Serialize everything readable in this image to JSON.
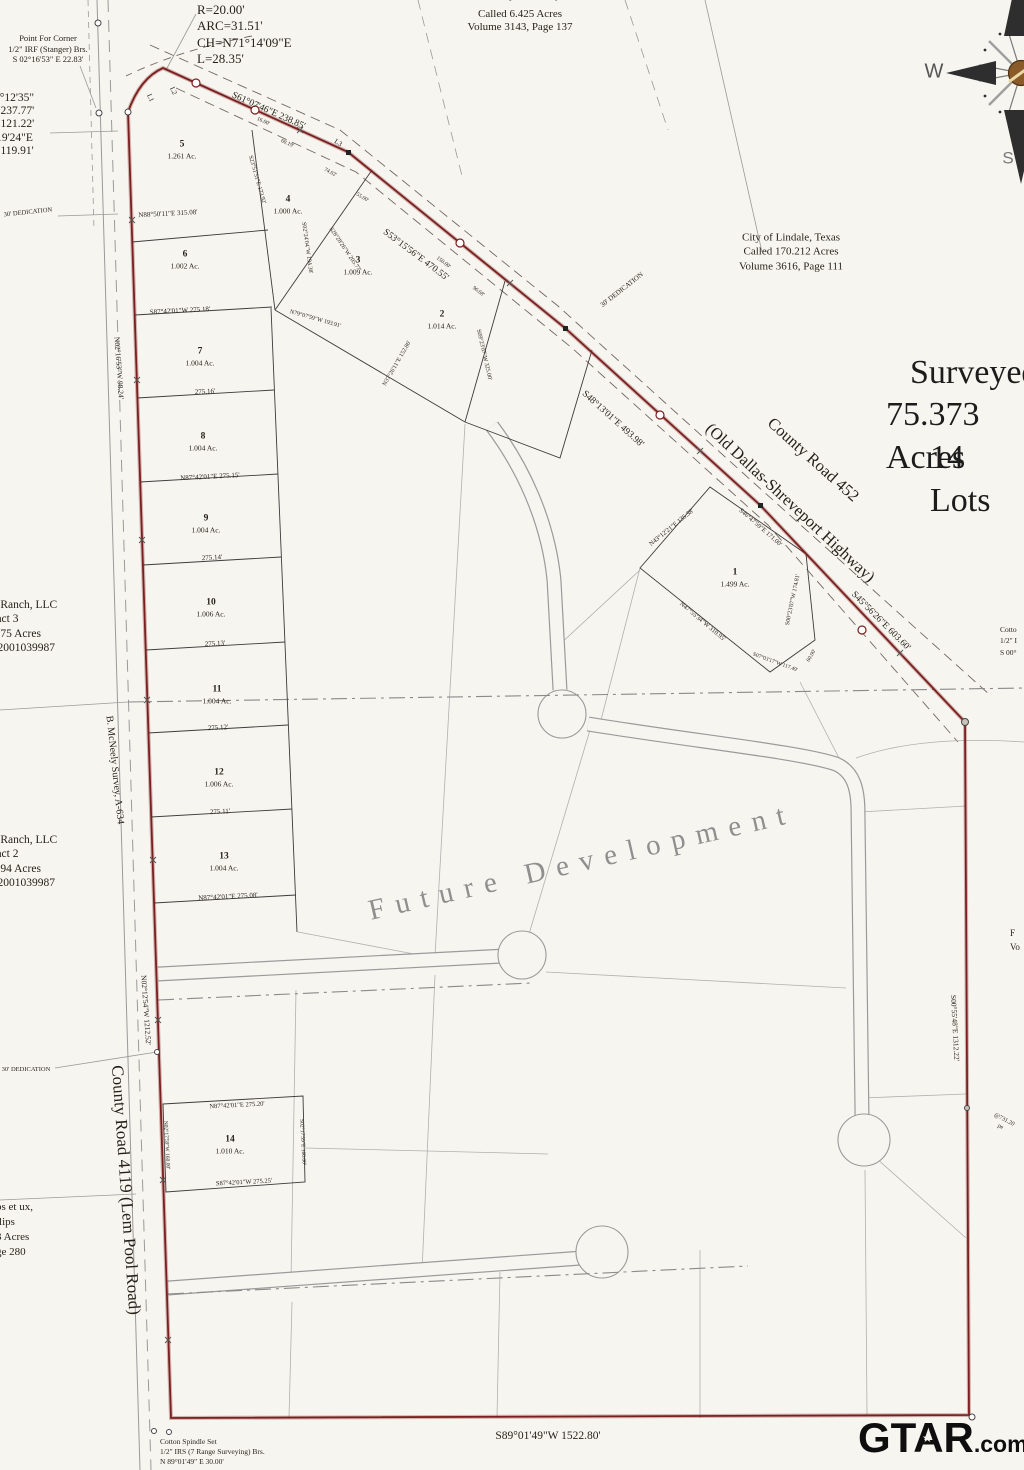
{
  "colors": {
    "paper": "#f7f5ef",
    "ink": "#241f19",
    "boundary_red": "#7a1f1f",
    "street_gray": "#9a9a9a",
    "parcel_gray": "#b0b0b0",
    "lot_line": "#3c3c3c",
    "centerline_gray": "#8a8a8a",
    "future_text_gray": "#8f8f8f",
    "compass_brown": "#8a5a28",
    "watermark_black": "#0e0e0e"
  },
  "watermark": {
    "main": "GTAR",
    "suffix": ".com",
    "star": "★"
  },
  "texts": [
    {
      "id": "point-for-corner-note",
      "t": "Point For Corner\n1/2\" IRF (Stanger) Brs.\nS 02°16'53\" E  22.83'",
      "x": 48,
      "y": 49,
      "s": 8.5,
      "a": "c"
    },
    {
      "id": "curve-data-note",
      "t": "R=20.00'\nARC=31.51'\nCH=N71°14'09\"E\nL=28.35'",
      "x": 197,
      "y": 2,
      "s": 13,
      "a": "tl",
      "lh": 1.25
    },
    {
      "id": "left-bearing-list",
      "t": "9°12'35\"\n=237.77'\n=121.22'\n'19'24\"E\n=119.91'",
      "x": -6,
      "y": 92,
      "s": 11.5,
      "a": "tl",
      "lh": 1.15
    },
    {
      "id": "trust-block-partial",
      "t": "Montez Vasquez Family Trust",
      "x": 520,
      "y": -4,
      "s": 11,
      "a": "c"
    },
    {
      "id": "trust-block",
      "t": "Called 6.425 Acres\nVolume 3143, Page 137",
      "x": 520,
      "y": 21,
      "s": 11,
      "a": "c",
      "lh": 1.2
    },
    {
      "id": "lindale-block",
      "t": "City of Lindale, Texas\nCalled 170.212 Acres\nVolume 3616, Page 111",
      "x": 791,
      "y": 252,
      "s": 11,
      "a": "c",
      "lh": 1.3
    },
    {
      "id": "ranch-tract3-block",
      "t": "19 Ranch, LLC\nTract 3\n8.775 Acres\n202001039987",
      "x": -14,
      "y": 598,
      "s": 11.5,
      "a": "tl",
      "lh": 1.25
    },
    {
      "id": "ranch-tract2-block",
      "t": "19 Ranch, LLC\nTract 2\n1.694 Acres\n202001039987",
      "x": -14,
      "y": 833,
      "s": 11.5,
      "a": "tl",
      "lh": 1.25
    },
    {
      "id": "phillips-block",
      "t": "ps et ux,\nllips\n3 Acres\nge 280",
      "x": -4,
      "y": 1200,
      "s": 11,
      "a": "tl",
      "lh": 1.35
    },
    {
      "id": "cotton-spindle-note",
      "t": "Cotton Spindle Set\n1/2\" IRS (7 Range Surveying) Brs.\nN 89°01'49\" E  30.00'",
      "x": 160,
      "y": 1437,
      "s": 7.5,
      "a": "tl",
      "lh": 1.35
    },
    {
      "id": "cotton-right-note",
      "t": "Cotto\n1/2\" I\nS 00°",
      "x": 1000,
      "y": 624,
      "s": 7.5,
      "a": "tl",
      "lh": 1.5
    },
    {
      "id": "right-edge-sliver",
      "t": "F\nVo",
      "x": 1010,
      "y": 926,
      "s": 9,
      "a": "tl",
      "lh": 1.6
    },
    {
      "id": "dedication-top",
      "t": "30' DEDICATION",
      "x": 28,
      "y": 213,
      "r": -6,
      "s": 6.5,
      "a": "c"
    },
    {
      "id": "dedication-hwy",
      "t": "30' DEDICATION",
      "x": 622,
      "y": 290,
      "r": -38,
      "s": 7,
      "a": "c"
    },
    {
      "id": "dedication-west",
      "t": "30' DEDICATION",
      "x": 26,
      "y": 1070,
      "s": 6.5,
      "a": "c"
    },
    {
      "id": "future-development-label",
      "t": "Future Development",
      "x": 582,
      "y": 862,
      "r": -13,
      "s": 29,
      "a": "c",
      "ls": 11,
      "c": "#8f8f8f"
    },
    {
      "id": "title-line1",
      "t": "Surveyed",
      "x": 910,
      "y": 352,
      "s": 34,
      "a": "tl",
      "c": "#1c1c1c"
    },
    {
      "id": "title-line2",
      "t": "75.373 Acres",
      "x": 886,
      "y": 394,
      "s": 34,
      "a": "tl",
      "c": "#1c1c1c"
    },
    {
      "id": "title-line3",
      "t": "14 Lots",
      "x": 930,
      "y": 437,
      "s": 34,
      "a": "tl",
      "c": "#1c1c1c"
    },
    {
      "id": "highway-name",
      "t": "County Road 452",
      "x": 813,
      "y": 460,
      "r": 42,
      "s": 16.5,
      "a": "c"
    },
    {
      "id": "highway-name-sub",
      "t": "(Old Dallas-Shreveport Highway)",
      "x": 790,
      "y": 503,
      "r": 43,
      "s": 16.5,
      "a": "c"
    },
    {
      "id": "west-road-name",
      "t": "County Road 4119  (Lem Pool Road)",
      "x": 126,
      "y": 1190,
      "r": 86,
      "s": 17,
      "a": "c"
    },
    {
      "id": "survey-line-name",
      "t": "B. McNeely Survey, A-634",
      "x": 114,
      "y": 770,
      "r": 84,
      "s": 10,
      "a": "c"
    },
    {
      "id": "compass-w-label",
      "t": "W",
      "x": 934,
      "y": 72,
      "s": 20,
      "a": "c",
      "c": "#555",
      "f": "sans"
    },
    {
      "id": "compass-s-label",
      "t": "S",
      "x": 1008,
      "y": 158,
      "s": 17,
      "a": "c",
      "c": "#777",
      "f": "sans"
    },
    {
      "id": "brg-hwy-1",
      "t": "S61°07'46\"E  238.85'",
      "x": 268,
      "y": 112,
      "r": 24,
      "s": 9.5,
      "a": "c"
    },
    {
      "id": "brg-hwy-2",
      "t": "S53°15'56\"E  470.55'",
      "x": 415,
      "y": 256,
      "r": 37,
      "s": 9.5,
      "a": "c"
    },
    {
      "id": "brg-hwy-3",
      "t": "S48°13'01\"E  493.98'",
      "x": 612,
      "y": 420,
      "r": 42,
      "s": 9.5,
      "a": "c"
    },
    {
      "id": "brg-hwy-4",
      "t": "S45°56'26\"E  603.60'",
      "x": 880,
      "y": 622,
      "r": 45,
      "s": 9.5,
      "a": "c"
    },
    {
      "id": "brg-west-1",
      "t": "N02°16'53\"W  98.24'",
      "x": 119,
      "y": 368,
      "r": 86,
      "s": 7.5,
      "a": "c"
    },
    {
      "id": "brg-west-2",
      "t": "N02°12'54\"W  1212.52'",
      "x": 146,
      "y": 1010,
      "r": 86,
      "s": 7.5,
      "a": "c"
    },
    {
      "id": "brg-east",
      "t": "S00°55'48\"E  1312.22'",
      "x": 955,
      "y": 1028,
      "r": 87,
      "s": 7.5,
      "a": "c"
    },
    {
      "id": "brg-south",
      "t": "S89°01'49\"W  1522.80'",
      "x": 548,
      "y": 1436,
      "s": 11.5,
      "a": "c"
    },
    {
      "id": "brg-lot56",
      "t": "N88°50'11\"E  315.08'",
      "x": 168,
      "y": 214,
      "r": -3,
      "s": 7,
      "a": "c"
    },
    {
      "id": "brg-lot67",
      "t": "S87°42'01\"W  275.18'",
      "x": 180,
      "y": 311,
      "r": -3,
      "s": 7,
      "a": "c"
    },
    {
      "id": "dim-275-16",
      "t": "275.16'",
      "x": 205,
      "y": 392,
      "r": -3,
      "s": 7,
      "a": "c"
    },
    {
      "id": "brg-lot89",
      "t": "N87°42'01\"E  275.15'",
      "x": 210,
      "y": 477,
      "r": -3,
      "s": 7,
      "a": "c"
    },
    {
      "id": "dim-275-14",
      "t": "275.14'",
      "x": 212,
      "y": 558,
      "r": -3,
      "s": 7,
      "a": "c"
    },
    {
      "id": "dim-275-13",
      "t": "275.13'",
      "x": 215,
      "y": 644,
      "r": -3,
      "s": 7,
      "a": "c"
    },
    {
      "id": "dim-275-12",
      "t": "275.12'",
      "x": 218,
      "y": 728,
      "r": -3,
      "s": 7,
      "a": "c"
    },
    {
      "id": "dim-275-11",
      "t": "275.11'",
      "x": 220,
      "y": 812,
      "r": -3,
      "s": 7,
      "a": "c"
    },
    {
      "id": "brg-lot13-s",
      "t": "N87°42'01\"E  275.08'",
      "x": 228,
      "y": 897,
      "r": -3,
      "s": 7,
      "a": "c"
    },
    {
      "id": "brg-lot14-n",
      "t": "N87°42'01\"E  275.20'",
      "x": 237,
      "y": 1106,
      "r": -3,
      "s": 6.5,
      "a": "c"
    },
    {
      "id": "brg-lot14-s",
      "t": "S87°42'01\"W  275.25'",
      "x": 244,
      "y": 1183,
      "r": -3,
      "s": 6.5,
      "a": "c"
    },
    {
      "id": "brg-lot14-e",
      "t": "S02°17'59\"E  160.00'",
      "x": 302,
      "y": 1142,
      "r": 87,
      "s": 5.5,
      "a": "c"
    },
    {
      "id": "brg-lot14-w",
      "t": "N02°17'59\"W  160.00'",
      "x": 166,
      "y": 1145,
      "r": 87,
      "s": 5.5,
      "a": "c"
    },
    {
      "id": "brg-lot1-a",
      "t": "N43°12'21\"E  135.38'",
      "x": 672,
      "y": 528,
      "r": -39,
      "s": 6.5,
      "a": "c"
    },
    {
      "id": "brg-lot1-b",
      "t": "S46°47'59\"E  171.00'",
      "x": 760,
      "y": 528,
      "r": 41,
      "s": 6.5,
      "a": "c"
    },
    {
      "id": "brg-lot1-c",
      "t": "N47°55'34\"W  310.95'",
      "x": 702,
      "y": 622,
      "r": 40,
      "s": 6.5,
      "a": "c"
    },
    {
      "id": "brg-lot1-d",
      "t": "S00°23'07\"W  174.81'",
      "x": 794,
      "y": 600,
      "r": -78,
      "s": 6,
      "a": "c"
    },
    {
      "id": "brg-lot1-e",
      "t": "S07°03'17\"W  117.49'",
      "x": 775,
      "y": 663,
      "r": 20,
      "s": 5.5,
      "a": "c"
    },
    {
      "id": "dim-60",
      "t": "60.00'",
      "x": 812,
      "y": 656,
      "r": -60,
      "s": 5.5,
      "a": "c"
    },
    {
      "id": "brg-fan-a",
      "t": "S23°51'51\"E  173.92'",
      "x": 256,
      "y": 180,
      "r": 74,
      "s": 6,
      "a": "c"
    },
    {
      "id": "brg-fan-b",
      "t": "S02°24'04\"W  194.38'",
      "x": 306,
      "y": 248,
      "r": 82,
      "s": 6,
      "a": "c"
    },
    {
      "id": "brg-fan-c",
      "t": "S28°28'26\"W  205.77'",
      "x": 344,
      "y": 250,
      "r": 56,
      "s": 6,
      "a": "c"
    },
    {
      "id": "brg-fan-d",
      "t": "N79°07'59\"W  193.91'",
      "x": 315,
      "y": 320,
      "r": 16,
      "s": 6,
      "a": "c"
    },
    {
      "id": "brg-fan-e",
      "t": "N37°26'11\"E  152.86'",
      "x": 398,
      "y": 364,
      "r": -60,
      "s": 6,
      "a": "c"
    },
    {
      "id": "brg-lot2-e",
      "t": "S09°23'07\"W  325.00'",
      "x": 483,
      "y": 355,
      "r": 77,
      "s": 6,
      "a": "c"
    },
    {
      "id": "lbl-l1",
      "t": "L1",
      "x": 150,
      "y": 98,
      "r": 65,
      "s": 7,
      "a": "c"
    },
    {
      "id": "lbl-l2",
      "t": "L2",
      "x": 173,
      "y": 91,
      "r": 65,
      "s": 7,
      "a": "c"
    },
    {
      "id": "lbl-l3",
      "t": "L3",
      "x": 338,
      "y": 143,
      "r": 32,
      "s": 7,
      "a": "c"
    },
    {
      "id": "dim-16",
      "t": "16.00'",
      "x": 263,
      "y": 122,
      "r": 24,
      "s": 5.5,
      "a": "c"
    },
    {
      "id": "dim-6019",
      "t": "60.19'",
      "x": 287,
      "y": 144,
      "r": 24,
      "s": 5.5,
      "a": "c"
    },
    {
      "id": "dim-7402",
      "t": "74.02'",
      "x": 330,
      "y": 173,
      "r": 28,
      "s": 5.5,
      "a": "c"
    },
    {
      "id": "dim-55",
      "t": "55.00'",
      "x": 362,
      "y": 198,
      "r": 31,
      "s": 5.5,
      "a": "c"
    },
    {
      "id": "dim-150",
      "t": "150.00'",
      "x": 443,
      "y": 263,
      "r": 37,
      "s": 5.5,
      "a": "c"
    },
    {
      "id": "dim-9668",
      "t": "96.68'",
      "x": 478,
      "y": 292,
      "r": 37,
      "s": 5.5,
      "a": "c"
    },
    {
      "id": "dim-731",
      "t": "@731.20 pe",
      "x": 1002,
      "y": 1124,
      "r": 28,
      "s": 6,
      "a": "c"
    }
  ],
  "lots": [
    {
      "n": "5",
      "ac": "1.261 Ac.",
      "x": 182,
      "y": 150
    },
    {
      "n": "4",
      "ac": "1.000 Ac.",
      "x": 288,
      "y": 205
    },
    {
      "n": "6",
      "ac": "1.002 Ac.",
      "x": 185,
      "y": 260
    },
    {
      "n": "3",
      "ac": "1.009 Ac.",
      "x": 358,
      "y": 266
    },
    {
      "n": "2",
      "ac": "1.014 Ac.",
      "x": 442,
      "y": 320
    },
    {
      "n": "7",
      "ac": "1.004 Ac.",
      "x": 200,
      "y": 357
    },
    {
      "n": "8",
      "ac": "1.004 Ac.",
      "x": 203,
      "y": 442
    },
    {
      "n": "9",
      "ac": "1.004 Ac.",
      "x": 206,
      "y": 524
    },
    {
      "n": "10",
      "ac": "1.006 Ac.",
      "x": 211,
      "y": 608
    },
    {
      "n": "11",
      "ac": "1.004 Ac.",
      "x": 217,
      "y": 695
    },
    {
      "n": "12",
      "ac": "1.006 Ac.",
      "x": 219,
      "y": 778
    },
    {
      "n": "13",
      "ac": "1.004 Ac.",
      "x": 224,
      "y": 862
    },
    {
      "n": "14",
      "ac": "1.010 Ac.",
      "x": 230,
      "y": 1145
    },
    {
      "n": "1",
      "ac": "1.499 Ac.",
      "x": 735,
      "y": 578
    }
  ]
}
